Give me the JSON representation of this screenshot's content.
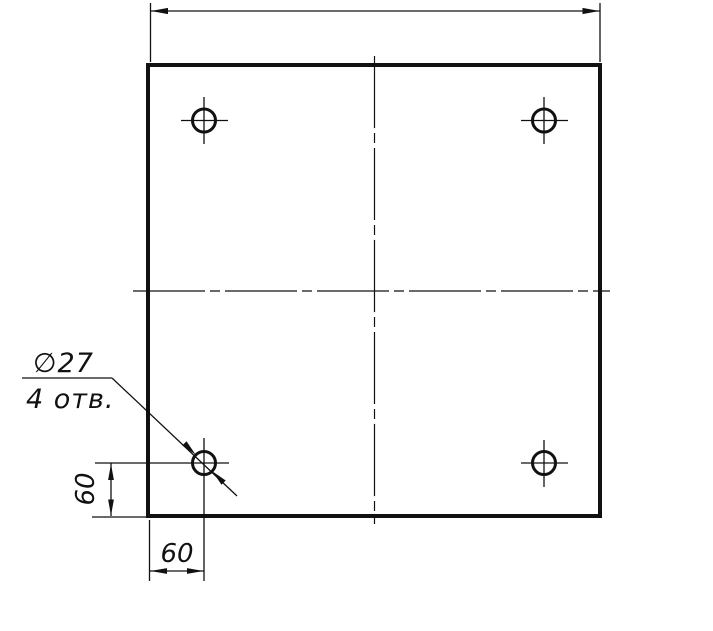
{
  "colors": {
    "ink": "#111111",
    "paper": "#ffffff"
  },
  "callout": {
    "diameter": "∅27",
    "count": "4 отв."
  },
  "dimensions": {
    "left_vertical": "60",
    "bottom_horizontal": "60"
  }
}
